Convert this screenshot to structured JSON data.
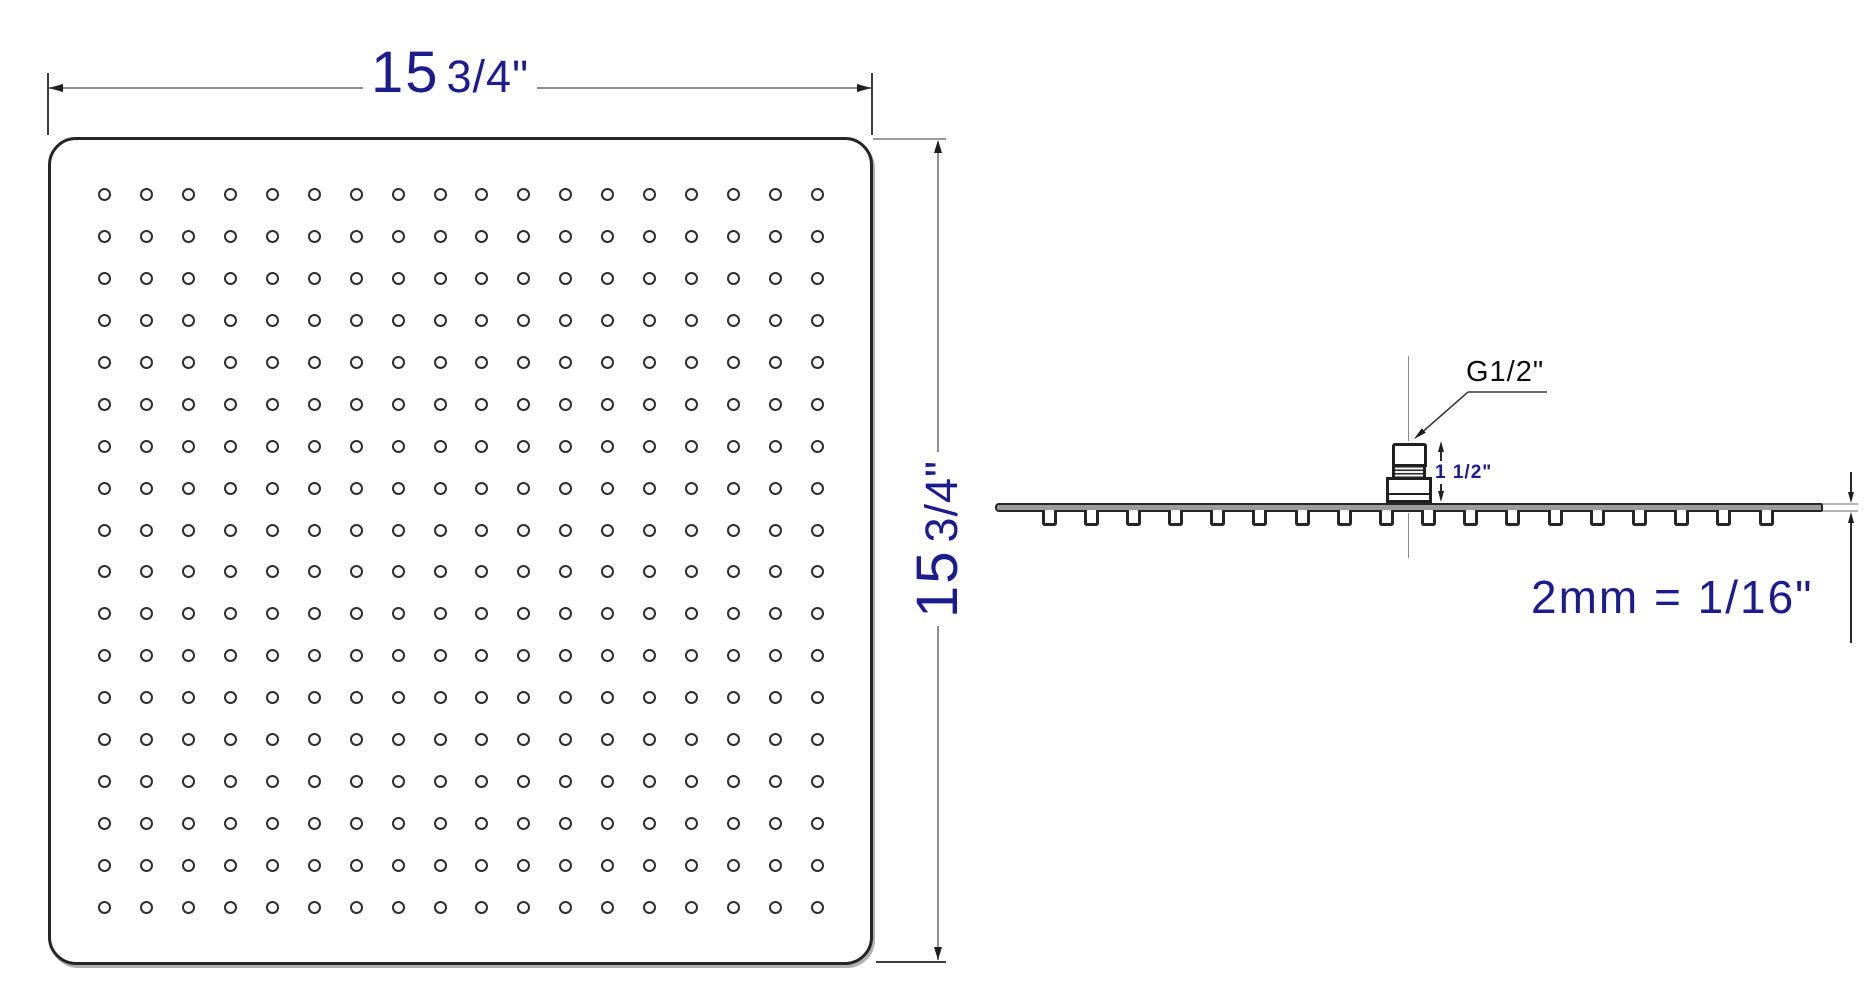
{
  "face_view": {
    "width_dimension": {
      "whole": "15",
      "fraction": "3/4\""
    },
    "height_dimension": {
      "whole": "15",
      "fraction": "3/4\""
    },
    "nozzle_grid": {
      "rows": 18,
      "cols": 18
    }
  },
  "profile_view": {
    "connector_label": "G1/2\"",
    "connector_height": "1 1/2\"",
    "plate_thickness": "2mm = 1/16\"",
    "nozzle_count": 18
  },
  "colors": {
    "dimension_text": "#1c1c8f",
    "drawing_line": "#262626",
    "dim_line": "#8f8f8f"
  }
}
